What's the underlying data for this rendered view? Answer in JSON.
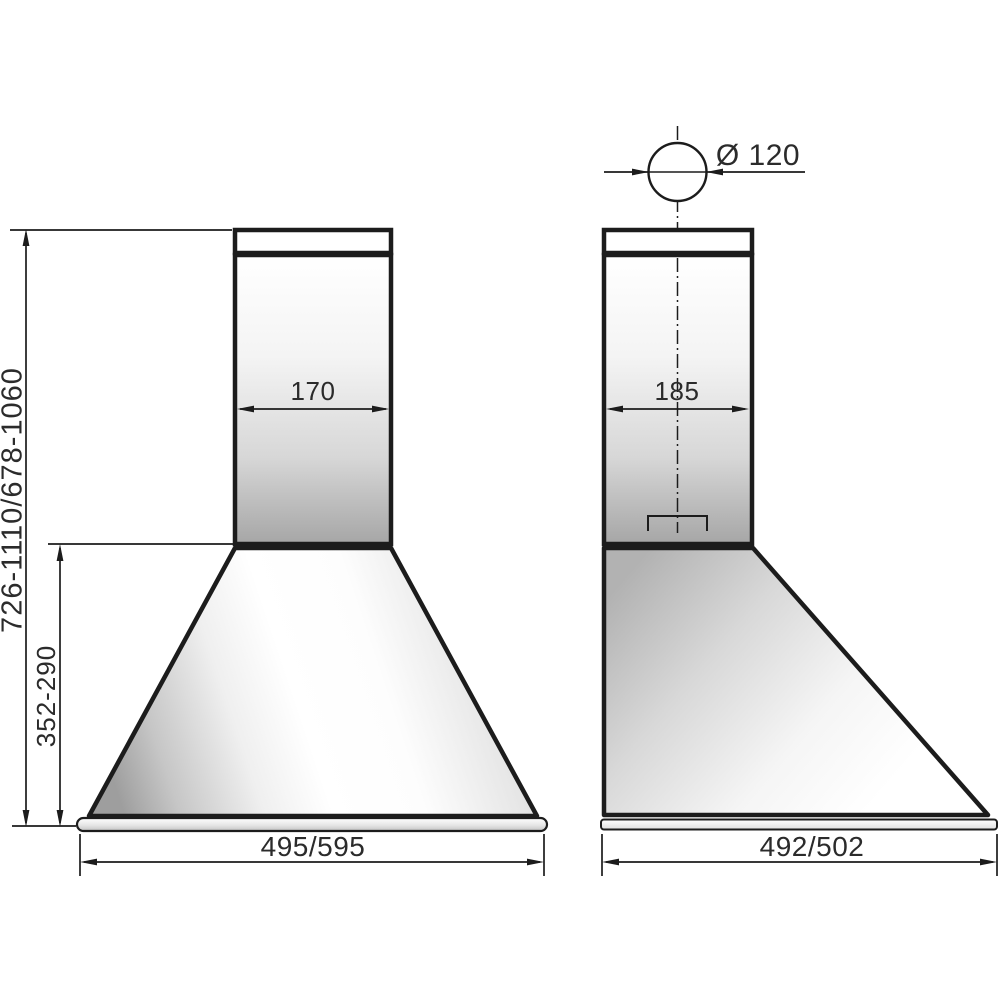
{
  "labels": {
    "front_duct_width": "170",
    "side_duct_depth": "185",
    "duct_diameter": "Ø 120",
    "overall_height_range": "726-1110/678-1060",
    "canopy_height_range": "352-290",
    "front_width_options": "495/595",
    "side_depth_options": "492/502"
  },
  "colors": {
    "line": "#1c1c1c",
    "text": "#2b2b2b",
    "background": "#ffffff"
  }
}
